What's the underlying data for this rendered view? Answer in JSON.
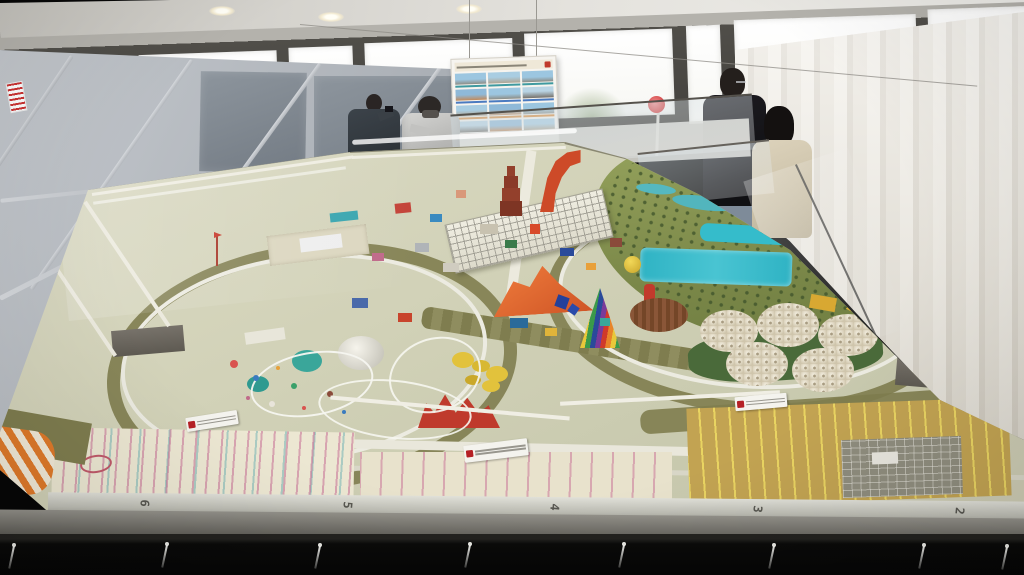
{
  "platform": {
    "grid_labels": [
      "6",
      "5",
      "4",
      "3",
      "2"
    ]
  },
  "info_board": {
    "columns": 3,
    "rows": 4,
    "photo_count": 12,
    "header_accent": "#c0392b"
  },
  "signs": {
    "model_plaque_count": 3,
    "wall_notice_accent": "#cc3333"
  },
  "people": {
    "left_pair": [
      "visitor-dark-jacket-photographing",
      "visitor-gray-puffer-jacket"
    ],
    "right_pair": [
      "visitor-black-coat",
      "visitor-beige-coat"
    ]
  },
  "palette": {
    "pool_teal": "#2fb3c4",
    "tower_red": "#cd4a28",
    "rainbow_stripes": [
      "#d03a2a",
      "#e8842a",
      "#e8c83a",
      "#3a9a4a",
      "#2a4a9a",
      "#7a3a9a"
    ],
    "dome_cream": "#e9e2cf",
    "embankment_olive": "#7f7d4f",
    "parking_mustard": "#c2a352",
    "curtain_beige": "#ece8df",
    "skirt_black": "#070707"
  },
  "counts": {
    "white_domes": 5,
    "hanging_ties": 8,
    "ceiling_lights": 7,
    "window_panes": 8
  }
}
